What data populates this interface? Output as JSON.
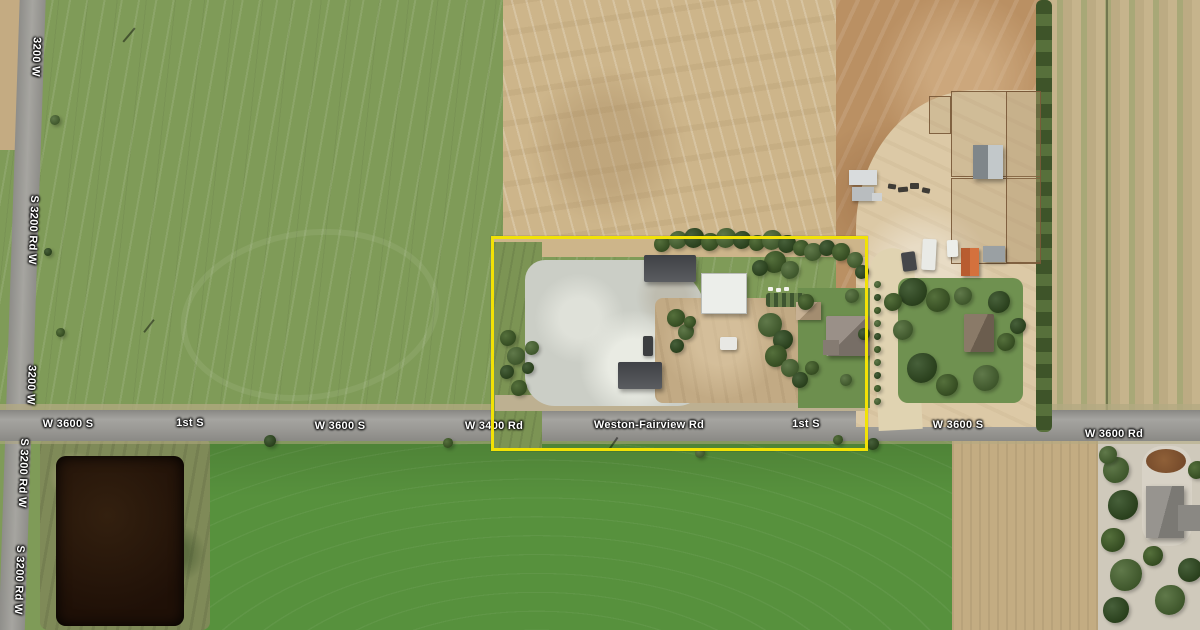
{
  "map": {
    "description": "Aerial satellite view of rural farmland with a yellow-highlighted parcel at a crossroads",
    "highlight_parcel": {
      "x": 491,
      "y": 236,
      "width": 377,
      "height": 215,
      "color": "#F2E205"
    },
    "road_labels_horizontal": [
      {
        "text": "W 3600 S",
        "x": 68,
        "y": 424
      },
      {
        "text": "1st S",
        "x": 190,
        "y": 423
      },
      {
        "text": "W 3600 S",
        "x": 340,
        "y": 426
      },
      {
        "text": "W 3400 Rd",
        "x": 494,
        "y": 426
      },
      {
        "text": "Weston-Fairview Rd",
        "x": 649,
        "y": 425
      },
      {
        "text": "1st S",
        "x": 806,
        "y": 424
      },
      {
        "text": "W 3600 S",
        "x": 958,
        "y": 425
      },
      {
        "text": "W 3600 Rd",
        "x": 1114,
        "y": 434
      }
    ],
    "road_labels_vertical": [
      {
        "text": "3200 W",
        "x": 36,
        "y": 57
      },
      {
        "text": "S 3200 Rd W",
        "x": 33,
        "y": 230
      },
      {
        "text": "3200 W",
        "x": 31,
        "y": 385
      },
      {
        "text": "S 3200 Rd W",
        "x": 23,
        "y": 473
      },
      {
        "text": "S 3200 Rd W",
        "x": 19,
        "y": 580
      }
    ],
    "colors": {
      "highlight_yellow": "#F2E205",
      "label_text": "#FFFFFF",
      "field_green_northwest": "#7F9B58",
      "field_green_south": "#57913D",
      "field_tan": "#CDB58A",
      "field_brown": "#BA9063",
      "road_gray": "#9B9A96",
      "pond_dark": "#2B1A0E"
    }
  }
}
